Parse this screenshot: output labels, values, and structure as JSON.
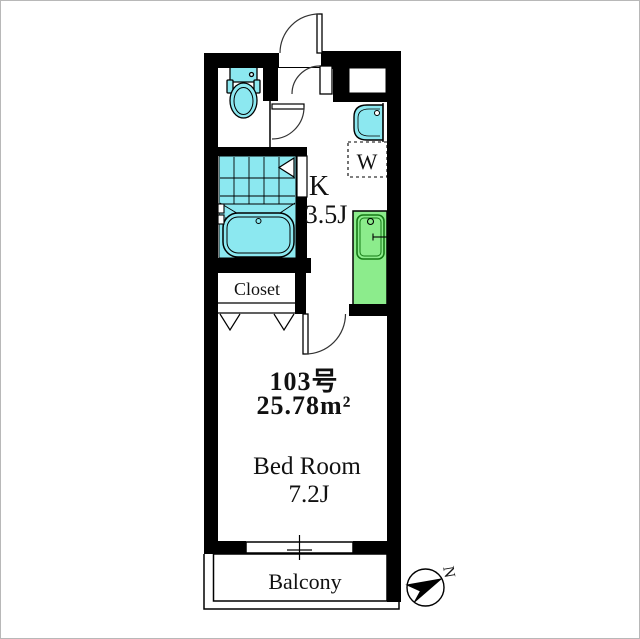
{
  "floor_plan": {
    "unit": {
      "number": "103号",
      "area": "25.78m²"
    },
    "rooms": {
      "kitchen": {
        "label": "K",
        "size": "3.5J"
      },
      "bedroom": {
        "label": "Bed Room",
        "size": "7.2J"
      },
      "closet": {
        "label": "Closet"
      },
      "balcony": {
        "label": "Balcony"
      },
      "washer_space": {
        "label": "W"
      }
    },
    "compass": {
      "north_label": "N"
    },
    "colors": {
      "fixture_cyan": "#8ce8f0",
      "counter_green": "#8cec8c",
      "wall_black": "#000000",
      "background": "#ffffff"
    }
  }
}
